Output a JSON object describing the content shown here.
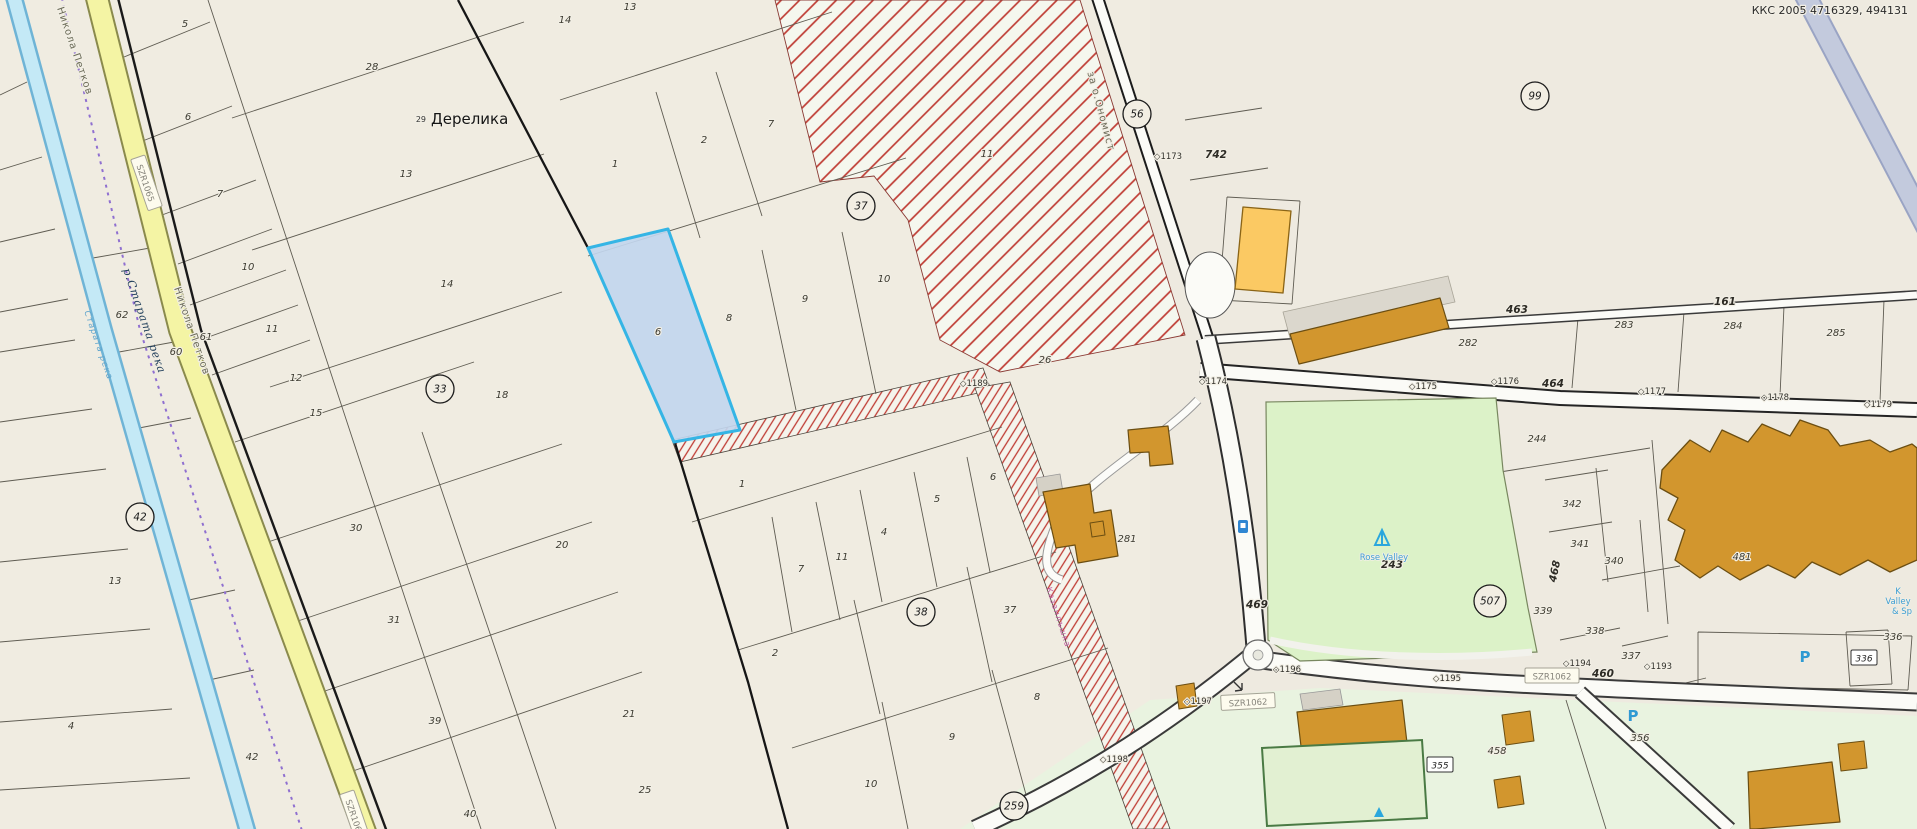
{
  "map": {
    "corner_code": "ККС 2005 4716329, 494131",
    "settlement": {
      "prefix": "29",
      "name": "Дерелика"
    },
    "colors": {
      "background": "#f0ece1",
      "river": "#b9e2f2",
      "road_yellow": "#f4f4a4",
      "hatch_red": "#bf3c34",
      "selection_blue": "#35b5e5",
      "selection_fill": "#c2d6ee",
      "park_green": "#dcf2c8",
      "building_gold": "#d2962e",
      "building_bright": "#fbc963",
      "boundary_purple": "#8f6fd0",
      "blue_band": "#bcc4da"
    },
    "circled": [
      {
        "t": "99",
        "x": 1535,
        "y": 96,
        "r": 14
      },
      {
        "t": "56",
        "x": 1137,
        "y": 114,
        "r": 14
      },
      {
        "t": "37",
        "x": 861,
        "y": 206,
        "r": 14
      },
      {
        "t": "33",
        "x": 440,
        "y": 389,
        "r": 14
      },
      {
        "t": "42",
        "x": 140,
        "y": 517,
        "r": 14
      },
      {
        "t": "38",
        "x": 921,
        "y": 612,
        "r": 14
      },
      {
        "t": "507",
        "x": 1490,
        "y": 601,
        "r": 16
      },
      {
        "t": "259",
        "x": 1014,
        "y": 806,
        "r": 14
      }
    ],
    "boxes": [
      {
        "t": "SZR1065",
        "x": 146,
        "y": 183,
        "r": 71,
        "w": 54,
        "k": "ref"
      },
      {
        "t": "SZR1065",
        "x": 355,
        "y": 818,
        "r": 71,
        "w": 54,
        "k": "ref"
      },
      {
        "t": "SZR1062",
        "x": 1248,
        "y": 702,
        "r": -3,
        "w": 54,
        "k": "ref"
      },
      {
        "t": "SZR1062",
        "x": 1552,
        "y": 676,
        "r": 0,
        "w": 54,
        "k": "ref"
      },
      {
        "t": "355",
        "x": 1440,
        "y": 765,
        "r": 0,
        "w": 26,
        "k": "cell"
      },
      {
        "t": "336",
        "x": 1864,
        "y": 658,
        "r": 0,
        "w": 26,
        "k": "cell"
      }
    ],
    "labels": [
      {
        "t": "5",
        "x": 185,
        "y": 27,
        "c": "p"
      },
      {
        "t": "6",
        "x": 188,
        "y": 120,
        "c": "p"
      },
      {
        "t": "7",
        "x": 220,
        "y": 197,
        "c": "p"
      },
      {
        "t": "10",
        "x": 248,
        "y": 270,
        "c": "p"
      },
      {
        "t": "11",
        "x": 272,
        "y": 332,
        "c": "p"
      },
      {
        "t": "12",
        "x": 296,
        "y": 381,
        "c": "p"
      },
      {
        "t": "15",
        "x": 316,
        "y": 416,
        "c": "p"
      },
      {
        "t": "28",
        "x": 372,
        "y": 70,
        "c": "p"
      },
      {
        "t": "13",
        "x": 406,
        "y": 177,
        "c": "p"
      },
      {
        "t": "14",
        "x": 447,
        "y": 287,
        "c": "p"
      },
      {
        "t": "18",
        "x": 502,
        "y": 398,
        "c": "p"
      },
      {
        "t": "30",
        "x": 356,
        "y": 531,
        "c": "p"
      },
      {
        "t": "31",
        "x": 394,
        "y": 623,
        "c": "p"
      },
      {
        "t": "39",
        "x": 435,
        "y": 724,
        "c": "p"
      },
      {
        "t": "40",
        "x": 470,
        "y": 817,
        "c": "p"
      },
      {
        "t": "20",
        "x": 562,
        "y": 548,
        "c": "p"
      },
      {
        "t": "21",
        "x": 629,
        "y": 717,
        "c": "p"
      },
      {
        "t": "25",
        "x": 645,
        "y": 793,
        "c": "p"
      },
      {
        "t": "14",
        "x": 565,
        "y": 23,
        "c": "p"
      },
      {
        "t": "13",
        "x": 630,
        "y": 10,
        "c": "p"
      },
      {
        "t": "62",
        "x": 122,
        "y": 318,
        "c": "p"
      },
      {
        "t": "61",
        "x": 206,
        "y": 340,
        "c": "p"
      },
      {
        "t": "60",
        "x": 176,
        "y": 355,
        "c": "p"
      },
      {
        "t": "13",
        "x": 115,
        "y": 584,
        "c": "p"
      },
      {
        "t": "4",
        "x": 71,
        "y": 729,
        "c": "p"
      },
      {
        "t": "42",
        "x": 252,
        "y": 760,
        "c": "p"
      },
      {
        "t": "1",
        "x": 615,
        "y": 167,
        "c": "p"
      },
      {
        "t": "2",
        "x": 704,
        "y": 143,
        "c": "p"
      },
      {
        "t": "7",
        "x": 771,
        "y": 127,
        "c": "p"
      },
      {
        "t": "8",
        "x": 729,
        "y": 321,
        "c": "p"
      },
      {
        "t": "9",
        "x": 805,
        "y": 302,
        "c": "p"
      },
      {
        "t": "10",
        "x": 884,
        "y": 282,
        "c": "p"
      },
      {
        "t": "6",
        "x": 658,
        "y": 335,
        "c": "p"
      },
      {
        "t": "11",
        "x": 987,
        "y": 157,
        "c": "p"
      },
      {
        "t": "26",
        "x": 1045,
        "y": 363,
        "c": "p"
      },
      {
        "t": "1",
        "x": 742,
        "y": 487,
        "c": "p"
      },
      {
        "t": "7",
        "x": 801,
        "y": 572,
        "c": "p"
      },
      {
        "t": "11",
        "x": 842,
        "y": 560,
        "c": "p"
      },
      {
        "t": "4",
        "x": 884,
        "y": 535,
        "c": "p"
      },
      {
        "t": "5",
        "x": 937,
        "y": 502,
        "c": "p"
      },
      {
        "t": "6",
        "x": 993,
        "y": 480,
        "c": "p"
      },
      {
        "t": "2",
        "x": 775,
        "y": 656,
        "c": "p"
      },
      {
        "t": "37",
        "x": 1010,
        "y": 613,
        "c": "p"
      },
      {
        "t": "8",
        "x": 1037,
        "y": 700,
        "c": "p"
      },
      {
        "t": "9",
        "x": 952,
        "y": 740,
        "c": "p"
      },
      {
        "t": "10",
        "x": 871,
        "y": 787,
        "c": "p"
      },
      {
        "t": "◇1189",
        "x": 974,
        "y": 386,
        "c": "s"
      },
      {
        "t": "◇1173",
        "x": 1168,
        "y": 159,
        "c": "s"
      },
      {
        "t": "742",
        "x": 1216,
        "y": 158,
        "c": "b"
      },
      {
        "t": "463",
        "x": 1517,
        "y": 313,
        "c": "b"
      },
      {
        "t": "161",
        "x": 1725,
        "y": 305,
        "c": "b"
      },
      {
        "t": "282",
        "x": 1468,
        "y": 346,
        "c": "p"
      },
      {
        "t": "283",
        "x": 1624,
        "y": 328,
        "c": "p"
      },
      {
        "t": "284",
        "x": 1733,
        "y": 329,
        "c": "p"
      },
      {
        "t": "285",
        "x": 1836,
        "y": 336,
        "c": "p"
      },
      {
        "t": "◇1174",
        "x": 1213,
        "y": 384,
        "c": "s"
      },
      {
        "t": "◇1175",
        "x": 1423,
        "y": 389,
        "c": "s"
      },
      {
        "t": "◇1176",
        "x": 1505,
        "y": 384,
        "c": "s"
      },
      {
        "t": "464",
        "x": 1553,
        "y": 387,
        "c": "b"
      },
      {
        "t": "◇1177",
        "x": 1652,
        "y": 394,
        "c": "s"
      },
      {
        "t": "◇1178",
        "x": 1775,
        "y": 400,
        "c": "s"
      },
      {
        "t": "◇1179",
        "x": 1878,
        "y": 407,
        "c": "s"
      },
      {
        "t": "244",
        "x": 1537,
        "y": 442,
        "c": "p"
      },
      {
        "t": "342",
        "x": 1572,
        "y": 507,
        "c": "p"
      },
      {
        "t": "341",
        "x": 1580,
        "y": 547,
        "c": "p"
      },
      {
        "t": "340",
        "x": 1614,
        "y": 564,
        "c": "p"
      },
      {
        "t": "468",
        "x": 1558,
        "y": 572,
        "c": "b",
        "r": -78
      },
      {
        "t": "339",
        "x": 1543,
        "y": 614,
        "c": "p"
      },
      {
        "t": "338",
        "x": 1595,
        "y": 634,
        "c": "p"
      },
      {
        "t": "337",
        "x": 1631,
        "y": 659,
        "c": "p"
      },
      {
        "t": "336",
        "x": 1893,
        "y": 640,
        "c": "p"
      },
      {
        "t": "481",
        "x": 1742,
        "y": 560,
        "c": "p"
      },
      {
        "t": "281",
        "x": 1127,
        "y": 542,
        "c": "p"
      },
      {
        "t": "469",
        "x": 1257,
        "y": 608,
        "c": "b"
      },
      {
        "t": "243",
        "x": 1392,
        "y": 568,
        "c": "b"
      },
      {
        "t": "Rose Valley",
        "x": 1384,
        "y": 560,
        "c": "blue"
      },
      {
        "t": "K",
        "x": 1898,
        "y": 594,
        "c": "blue"
      },
      {
        "t": "Valley",
        "x": 1898,
        "y": 604,
        "c": "blue"
      },
      {
        "t": "& Sp",
        "x": 1902,
        "y": 614,
        "c": "blue"
      },
      {
        "t": "P",
        "x": 1805,
        "y": 662,
        "c": "P"
      },
      {
        "t": "P",
        "x": 1633,
        "y": 721,
        "c": "P"
      },
      {
        "t": "◇1196",
        "x": 1287,
        "y": 672,
        "c": "s"
      },
      {
        "t": "◇1195",
        "x": 1447,
        "y": 681,
        "c": "s"
      },
      {
        "t": "460",
        "x": 1603,
        "y": 677,
        "c": "b"
      },
      {
        "t": "◇1193",
        "x": 1658,
        "y": 669,
        "c": "s"
      },
      {
        "t": "◇1194",
        "x": 1577,
        "y": 666,
        "c": "s"
      },
      {
        "t": "◇1197",
        "x": 1198,
        "y": 704,
        "c": "s"
      },
      {
        "t": "◇1198",
        "x": 1114,
        "y": 762,
        "c": "s"
      },
      {
        "t": "458",
        "x": 1497,
        "y": 754,
        "c": "p"
      },
      {
        "t": "356",
        "x": 1640,
        "y": 741,
        "c": "p"
      },
      {
        "t": "Никола Петков",
        "x": 72,
        "y": 52,
        "c": "st",
        "r": 71
      },
      {
        "t": "Никола Петков",
        "x": 189,
        "y": 332,
        "c": "st",
        "r": 71
      },
      {
        "t": "р.Старата река",
        "x": 141,
        "y": 322,
        "c": "rv",
        "r": 71
      },
      {
        "t": "Старата река",
        "x": 96,
        "y": 346,
        "c": "rv2",
        "r": 71
      },
      {
        "t": "за о.Ономист",
        "x": 1098,
        "y": 112,
        "c": "st",
        "r": 75
      },
      {
        "t": "Казанлъшка",
        "x": 1056,
        "y": 618,
        "c": "pk",
        "r": 72
      }
    ]
  }
}
